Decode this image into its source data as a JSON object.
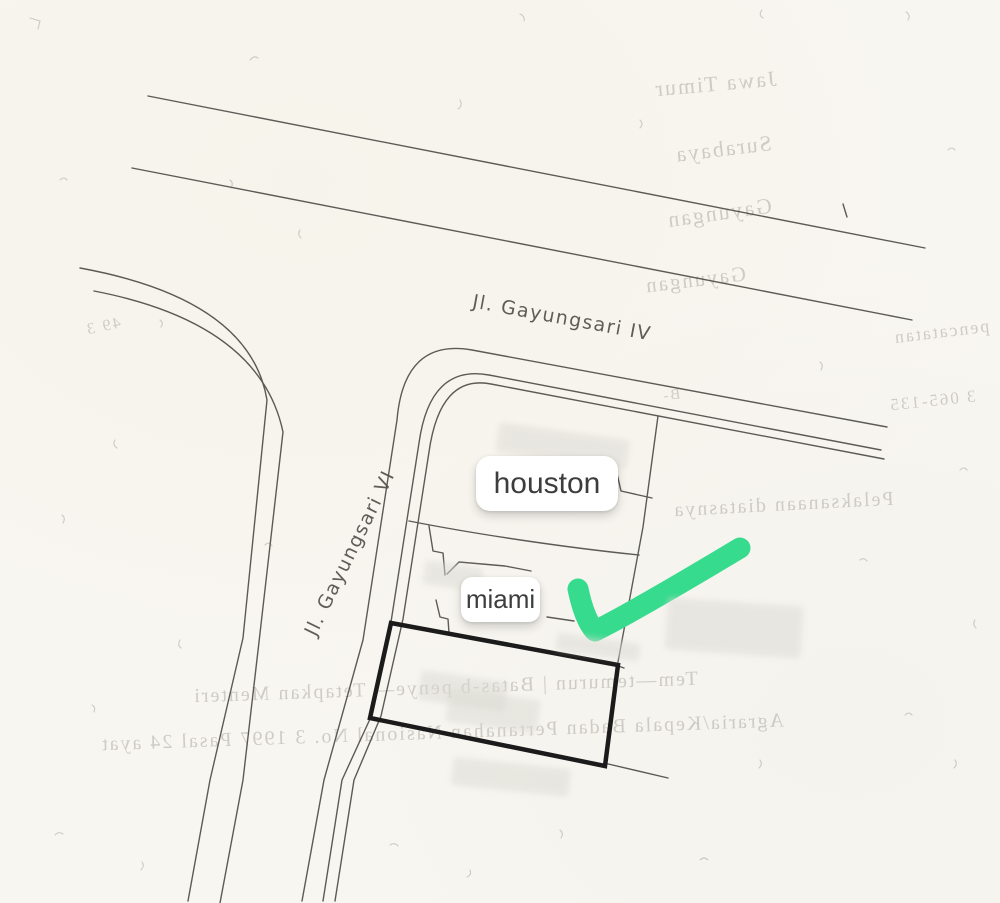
{
  "document": {
    "kind": "scanned land plot sketch"
  },
  "streets": [
    {
      "name": "Jl. Gayungsari IV",
      "cx": 562,
      "cy": 318,
      "rot": 10.5,
      "size": 19,
      "spacing": 1.5
    },
    {
      "name": "Jl. Gayungsari VI",
      "cx": 350,
      "cy": 553,
      "rot": -64,
      "size": 19,
      "spacing": 1.5
    }
  ],
  "markers": [
    {
      "id": "houston",
      "label": "houston",
      "x": 476,
      "y": 456,
      "w": 142,
      "h": 55,
      "font": 30,
      "radius": 14
    },
    {
      "id": "miami",
      "label": "miami",
      "x": 461,
      "y": 577,
      "w": 79,
      "h": 45,
      "font": 26,
      "radius": 11
    }
  ],
  "annotation": {
    "shape": "checkmark",
    "color": "#37db8e"
  },
  "highlight_plot": {
    "stroke": "#1b1b1b",
    "stroke_width": 4.5,
    "corners": [
      [
        391,
        623
      ],
      [
        618,
        665
      ],
      [
        605,
        766
      ],
      [
        370,
        718
      ]
    ]
  },
  "bleedthrough": [
    {
      "text": "Jawa Timur",
      "x": 715,
      "y": 84,
      "size": 22,
      "rot": -5
    },
    {
      "text": "Surabaya",
      "x": 723,
      "y": 149,
      "size": 22,
      "rot": -7
    },
    {
      "text": "Gayungan",
      "x": 719,
      "y": 213,
      "size": 22,
      "rot": -8
    },
    {
      "text": "Gayungan",
      "x": 695,
      "y": 280,
      "size": 21,
      "rot": -7
    },
    {
      "text": "pencatatan",
      "x": 941,
      "y": 332,
      "size": 18,
      "rot": -7
    },
    {
      "text": "3 065-135",
      "x": 932,
      "y": 401,
      "size": 17,
      "rot": -6
    },
    {
      "text": "B-",
      "x": 671,
      "y": 396,
      "size": 15,
      "rot": -8
    },
    {
      "text": "Pelaksanaan diatasnya",
      "x": 783,
      "y": 505,
      "size": 20,
      "rot": -3
    },
    {
      "text": "49 3",
      "x": 103,
      "y": 327,
      "size": 16,
      "rot": -12
    },
    {
      "text": "Tem—temurun |  Batas-b      penye—   Tetapkan   Menteri",
      "x": 445,
      "y": 688,
      "size": 20,
      "rot": -2
    },
    {
      "text": "Agraria/Kepala Badan Pertanahan Nasional No.  3  1997  Pasal  24 ayat",
      "x": 442,
      "y": 733,
      "size": 20,
      "rot": -2
    }
  ],
  "redactions": [
    {
      "x": 497,
      "y": 431,
      "w": 132,
      "h": 30,
      "rot": 8
    },
    {
      "x": 424,
      "y": 564,
      "w": 58,
      "h": 24,
      "rot": 8
    },
    {
      "x": 666,
      "y": 602,
      "w": 136,
      "h": 52,
      "rot": 4
    },
    {
      "x": 419,
      "y": 676,
      "w": 88,
      "h": 30,
      "rot": 8
    },
    {
      "x": 447,
      "y": 694,
      "w": 92,
      "h": 34,
      "rot": 8
    },
    {
      "x": 452,
      "y": 763,
      "w": 118,
      "h": 28,
      "rot": 6
    },
    {
      "x": 556,
      "y": 638,
      "w": 84,
      "h": 18,
      "rot": 8
    }
  ],
  "colors": {
    "paper": "#f8f6f1",
    "line": "#4b4a45",
    "bleed_text": "#b0aea6"
  }
}
